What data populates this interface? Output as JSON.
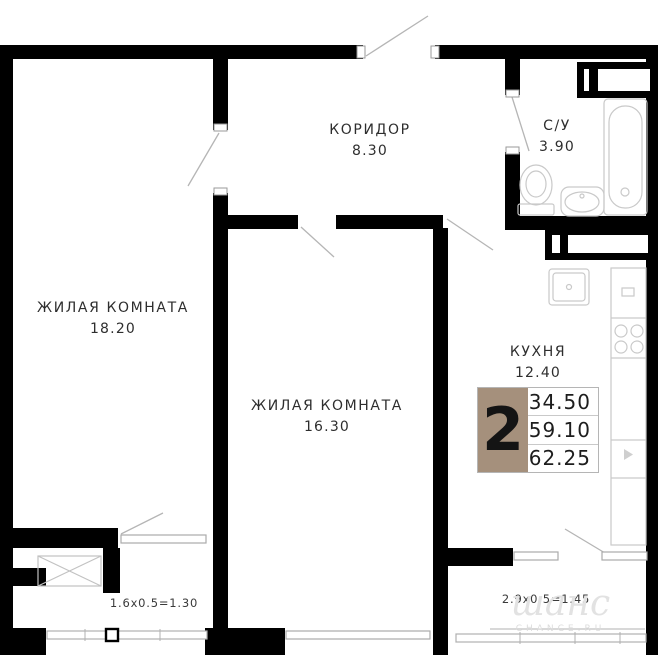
{
  "plan": {
    "rooms": [
      {
        "name": "КОРИДОР",
        "area": "8.30"
      },
      {
        "name": "С/У",
        "area": "3.90"
      },
      {
        "name": "ЖИЛАЯ КОМНАТА",
        "area": "18.20"
      },
      {
        "name": "ЖИЛАЯ КОМНАТА",
        "area": "16.30"
      },
      {
        "name": "КУХНЯ",
        "area": "12.40"
      }
    ],
    "balcony_dims": [
      "1.6х0.5=1.30",
      "2.9х0.5=1.45"
    ],
    "info_table": {
      "rooms_count": "2",
      "values": [
        "34.50",
        "59.10",
        "62.25"
      ],
      "accent_color": "#a5907c"
    },
    "watermark": {
      "script": "шанс",
      "caption": "CHANCE.RU"
    },
    "colors": {
      "wall": "#000000",
      "fixture_line": "#c9c9c9",
      "accent": "#a5907c",
      "watermark": "#e0e0e0"
    }
  }
}
